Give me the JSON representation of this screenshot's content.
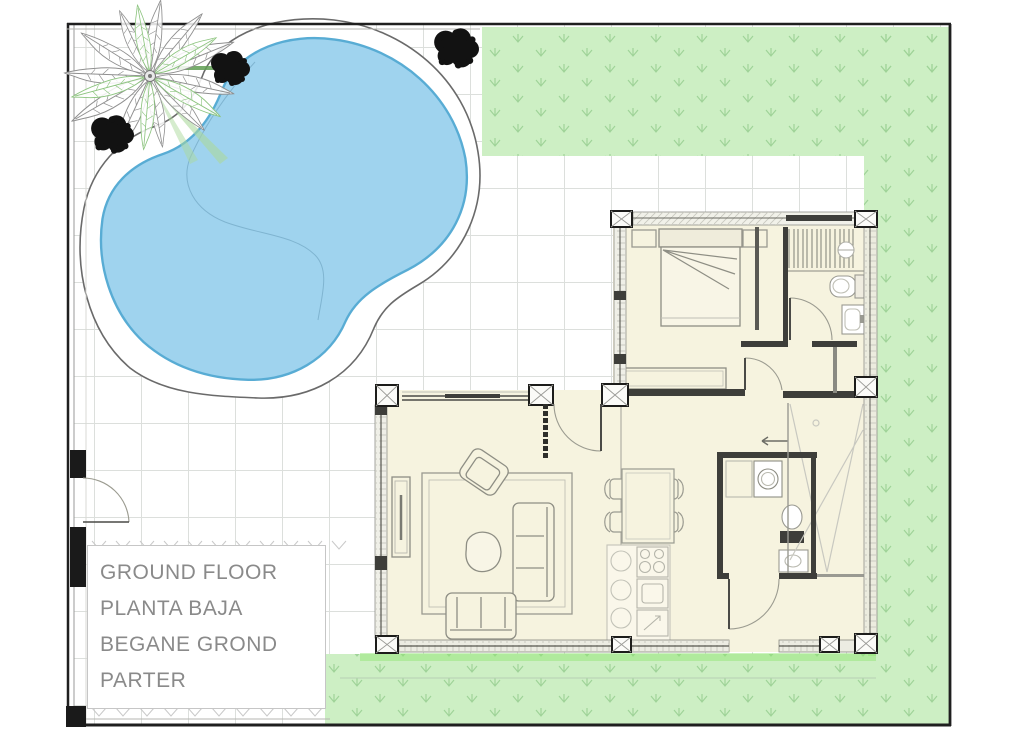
{
  "title_block": {
    "lines": [
      "GROUND FLOOR",
      "PLANTA BAJA",
      "BEGANE GROND",
      "PARTER"
    ]
  },
  "colors": {
    "pool_water": "#9fd3ee",
    "pool_edge": "#58acd4",
    "deck_fill": "#ffffff",
    "grass": "#cdefc4",
    "grass_mark": "#9fd398",
    "grass_highlight": "#8fe56e",
    "floor": "#f6f3df",
    "wall_dark": "#3e3e3a",
    "boundary": "#1f1f1f",
    "label_text": "#8a8a8a",
    "palm_leaf_gray": "#8f8f8f",
    "palm_leaf_green": "#8cc47e",
    "bush_black": "#121212",
    "grid_line": "#dcdfdc"
  }
}
